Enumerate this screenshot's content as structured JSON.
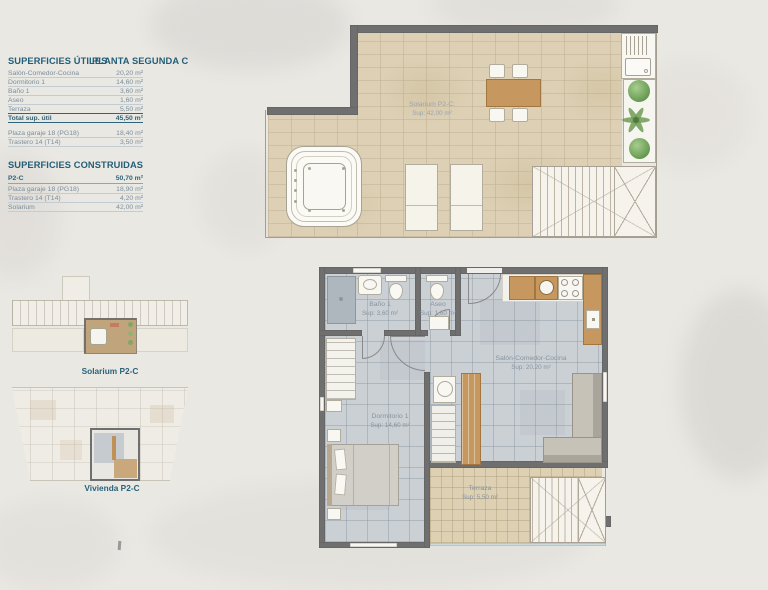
{
  "tables": {
    "utiles": {
      "title": "SUPERFICIES ÚTILES",
      "subtitle": "PLANTA SEGUNDA C",
      "rows": [
        {
          "label": "Salón-Comedor-Cocina",
          "value": "20,20 m²"
        },
        {
          "label": "Dormitorio 1",
          "value": "14,60 m²"
        },
        {
          "label": "Baño 1",
          "value": "3,60 m²"
        },
        {
          "label": "Aseo",
          "value": "1,60 m²"
        },
        {
          "label": "Terraza",
          "value": "5,50 m²"
        }
      ],
      "total": {
        "label": "Total sup. útil",
        "value": "45,50 m²"
      },
      "annex_rows": [
        {
          "label": "Plaza garaje 18 (PG18)",
          "value": "18,40 m²"
        },
        {
          "label": "Trastero 14 (T14)",
          "value": "3,50 m²"
        }
      ]
    },
    "construidas": {
      "title": "SUPERFICIES CONSTRUIDAS",
      "main_row": {
        "label": "P2-C",
        "value": "50,70 m²"
      },
      "rows": [
        {
          "label": "Plaza garaje 18 (PG18)",
          "value": "18,90 m²"
        },
        {
          "label": "Trastero 14 (T14)",
          "value": "4,20 m²"
        },
        {
          "label": "Solarium",
          "value": "42,00 m²"
        }
      ]
    }
  },
  "thumbnails": {
    "solarium_label": "Solarium P2-C",
    "vivienda_label": "Vivienda P2-C"
  },
  "solarium_plan": {
    "name": "Solarium P2-C:",
    "sup": "Sup: 42,00 m²"
  },
  "apartment_plan": {
    "rooms": [
      {
        "name": "Baño 1",
        "sup": "Sup: 3,60 m²"
      },
      {
        "name": "Aseo",
        "sup": "Sup: 1,60 m²"
      },
      {
        "name": "Salón-Comedor-Cocina",
        "sup": "Sup: 20,20 m²"
      },
      {
        "name": "Dormitorio 1",
        "sup": "Sup: 14,60 m²"
      },
      {
        "name": "Terraza",
        "sup": "Sup: 5,50 m²"
      }
    ]
  },
  "colors": {
    "accent_teal": "#245f77",
    "table_text": "#7b8e9b",
    "wall_gray": "#6f6f6f",
    "solarium_tile": "#ddd0b4",
    "apartment_floor": "#cbd0d5",
    "terrace_tile": "#ddd0b3",
    "wood": "#c6985f",
    "plant_green": "#6fa25a",
    "background": "#eae8e3"
  }
}
